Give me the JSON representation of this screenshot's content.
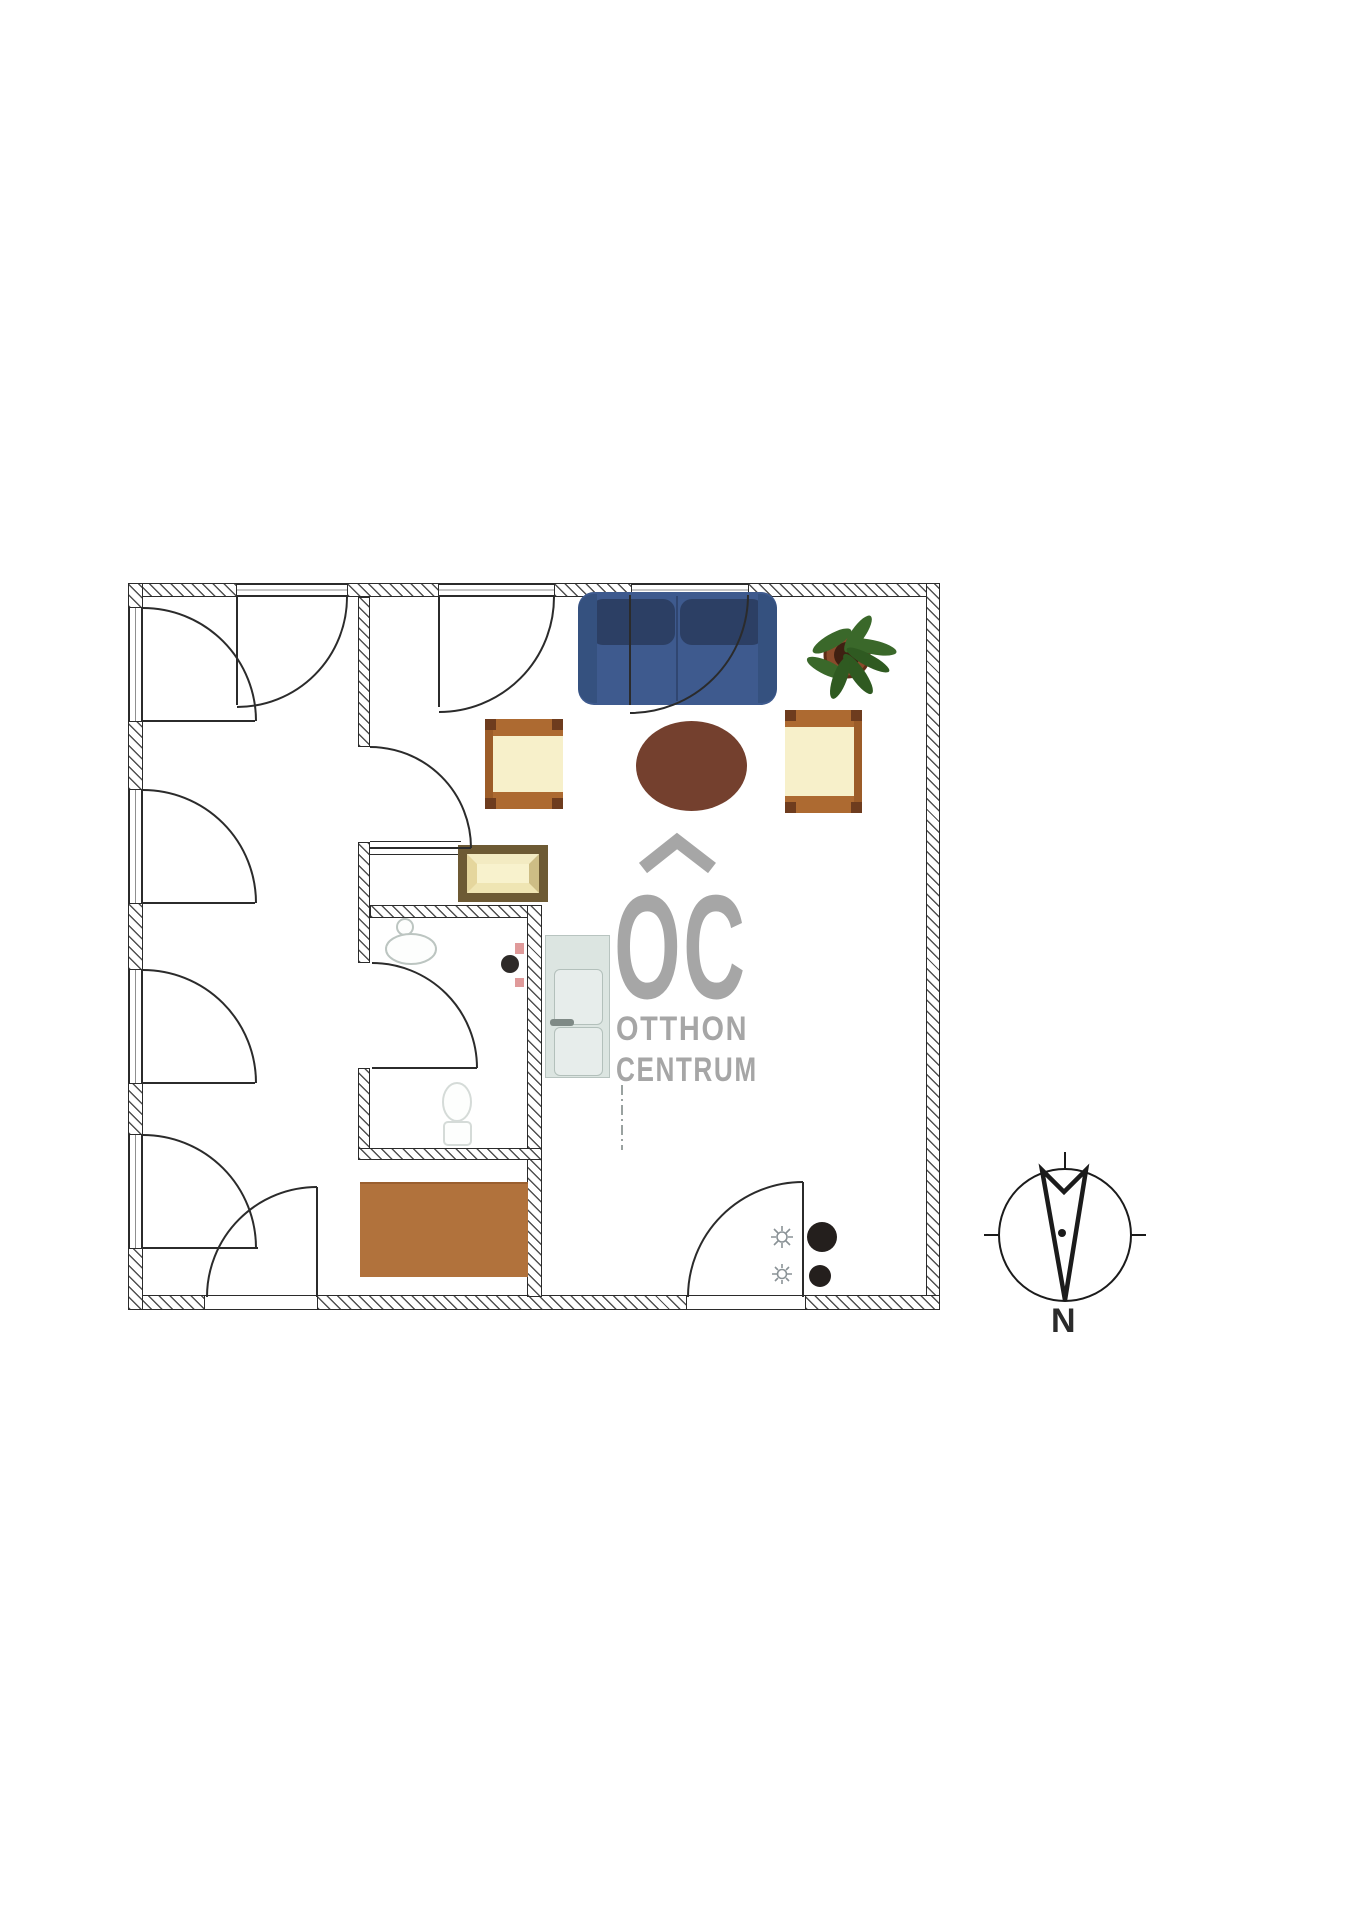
{
  "watermark": {
    "monogram": "OC",
    "word1": "OTTHON",
    "word2": "CENTRUM"
  },
  "compass": {
    "north_label": "N"
  },
  "furniture_icons": [
    "sofa",
    "oval-coffee-table",
    "armchair-left",
    "armchair-right",
    "side-table",
    "potted-plant",
    "rug",
    "refrigerator",
    "washbasin",
    "toilet",
    "ceiling-lamp-symbol",
    "column-dot"
  ],
  "palette": {
    "ink": "#2b2b2b",
    "sofa_body": "#3e5a8e",
    "sofa_shadow": "#2c3f64",
    "sofa_arm": "#35517f",
    "table_oval": "#74402e",
    "chair_band": "#ad6a31",
    "chair_body": "#f7f0ca",
    "side_table_frame": "#6d5a34",
    "side_table_top": "#f8f2cd",
    "rug": "#b1723c",
    "plant_pot": "#8a4a2b",
    "plant_leaf": "#3a682a",
    "plant_leaf_dark": "#2f5a21",
    "appliance": "#dce5e1",
    "watermark_gray": "#a6a6a6",
    "fixture_gray": "#bcc5c1",
    "accent_pink": "#e09a9a"
  }
}
